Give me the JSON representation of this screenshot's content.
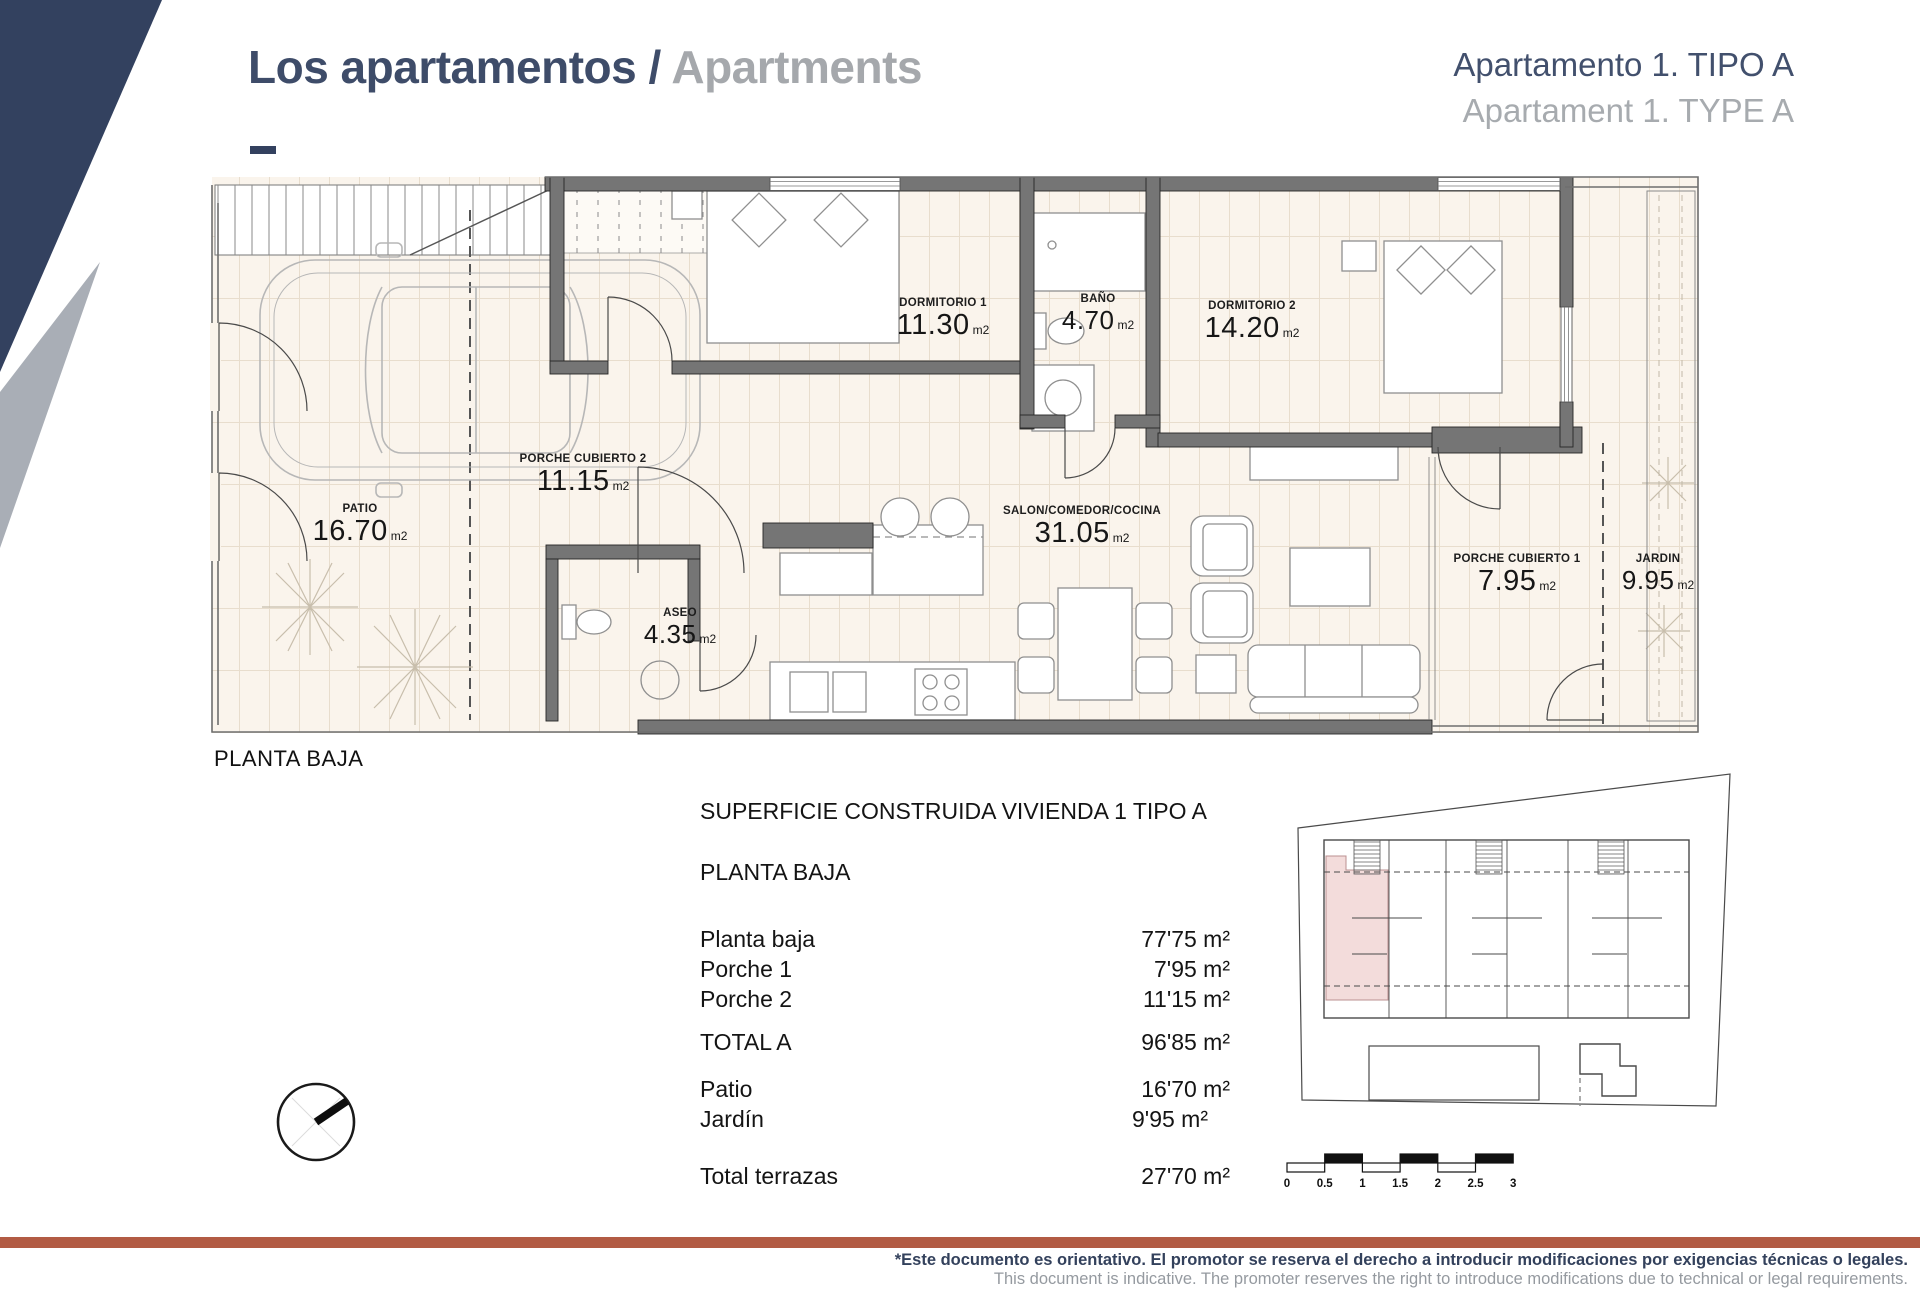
{
  "header": {
    "title_primary": "Los apartamentos",
    "title_separator": " / ",
    "title_secondary": "Apartments",
    "subtitle_line1": "Apartamento 1. TIPO A",
    "subtitle_line2": "Apartament 1. TYPE A"
  },
  "floor_plan": {
    "caption": "PLANTA BAJA",
    "rooms": [
      {
        "name": "DORMITORIO 1",
        "area": "11.30",
        "unit": "m2"
      },
      {
        "name": "BAÑO",
        "area": "4.70",
        "unit": "m2"
      },
      {
        "name": "DORMITORIO 2",
        "area": "14.20",
        "unit": "m2"
      },
      {
        "name": "PORCHE CUBIERTO 2",
        "area": "11.15",
        "unit": "m2"
      },
      {
        "name": "PATIO",
        "area": "16.70",
        "unit": "m2"
      },
      {
        "name": "ASEO",
        "area": "4.35",
        "unit": "m2"
      },
      {
        "name": "SALON/COMEDOR/COCINA",
        "area": "31.05",
        "unit": "m2"
      },
      {
        "name": "PORCHE CUBIERTO 1",
        "area": "7.95",
        "unit": "m2"
      },
      {
        "name": "JARDIN",
        "area": "9.95",
        "unit": "m2"
      }
    ]
  },
  "summary": {
    "title": "SUPERFICIE CONSTRUIDA VIVIENDA 1 TIPO A",
    "section": "PLANTA BAJA",
    "rows": [
      {
        "label": "Planta baja",
        "value": "77'75 m²"
      },
      {
        "label": "Porche 1",
        "value": "7'95 m²"
      },
      {
        "label": "Porche 2",
        "value": "11'15 m²"
      },
      {
        "label": "TOTAL A",
        "value": "96'85 m²"
      },
      {
        "label": "Patio",
        "value": "16'70 m²"
      },
      {
        "label": "Jardín",
        "value": "9'95 m²"
      },
      {
        "label": "Total terrazas",
        "value": "27'70 m²"
      }
    ]
  },
  "scale_bar": {
    "labels": [
      "0",
      "0.5",
      "1",
      "1.5",
      "2",
      "2.5",
      "3"
    ]
  },
  "footer": {
    "disclaimer_es": "*Este documento es orientativo. El promotor se reserva el derecho a introducir modificaciones por exigencias técnicas o legales.",
    "disclaimer_en": "This document is indicative. The promoter reserves the right to introduce modifications due to technical or legal requirements."
  },
  "colors": {
    "accent_navy": "#33415f",
    "accent_gray": "#a9aeb6",
    "text_gray": "#a5a8ac",
    "footer_bar": "#b25b44",
    "plan_floor": "#faf4ec",
    "plan_wall": "#757575",
    "siteplan_highlight": "#f3dcdb"
  }
}
